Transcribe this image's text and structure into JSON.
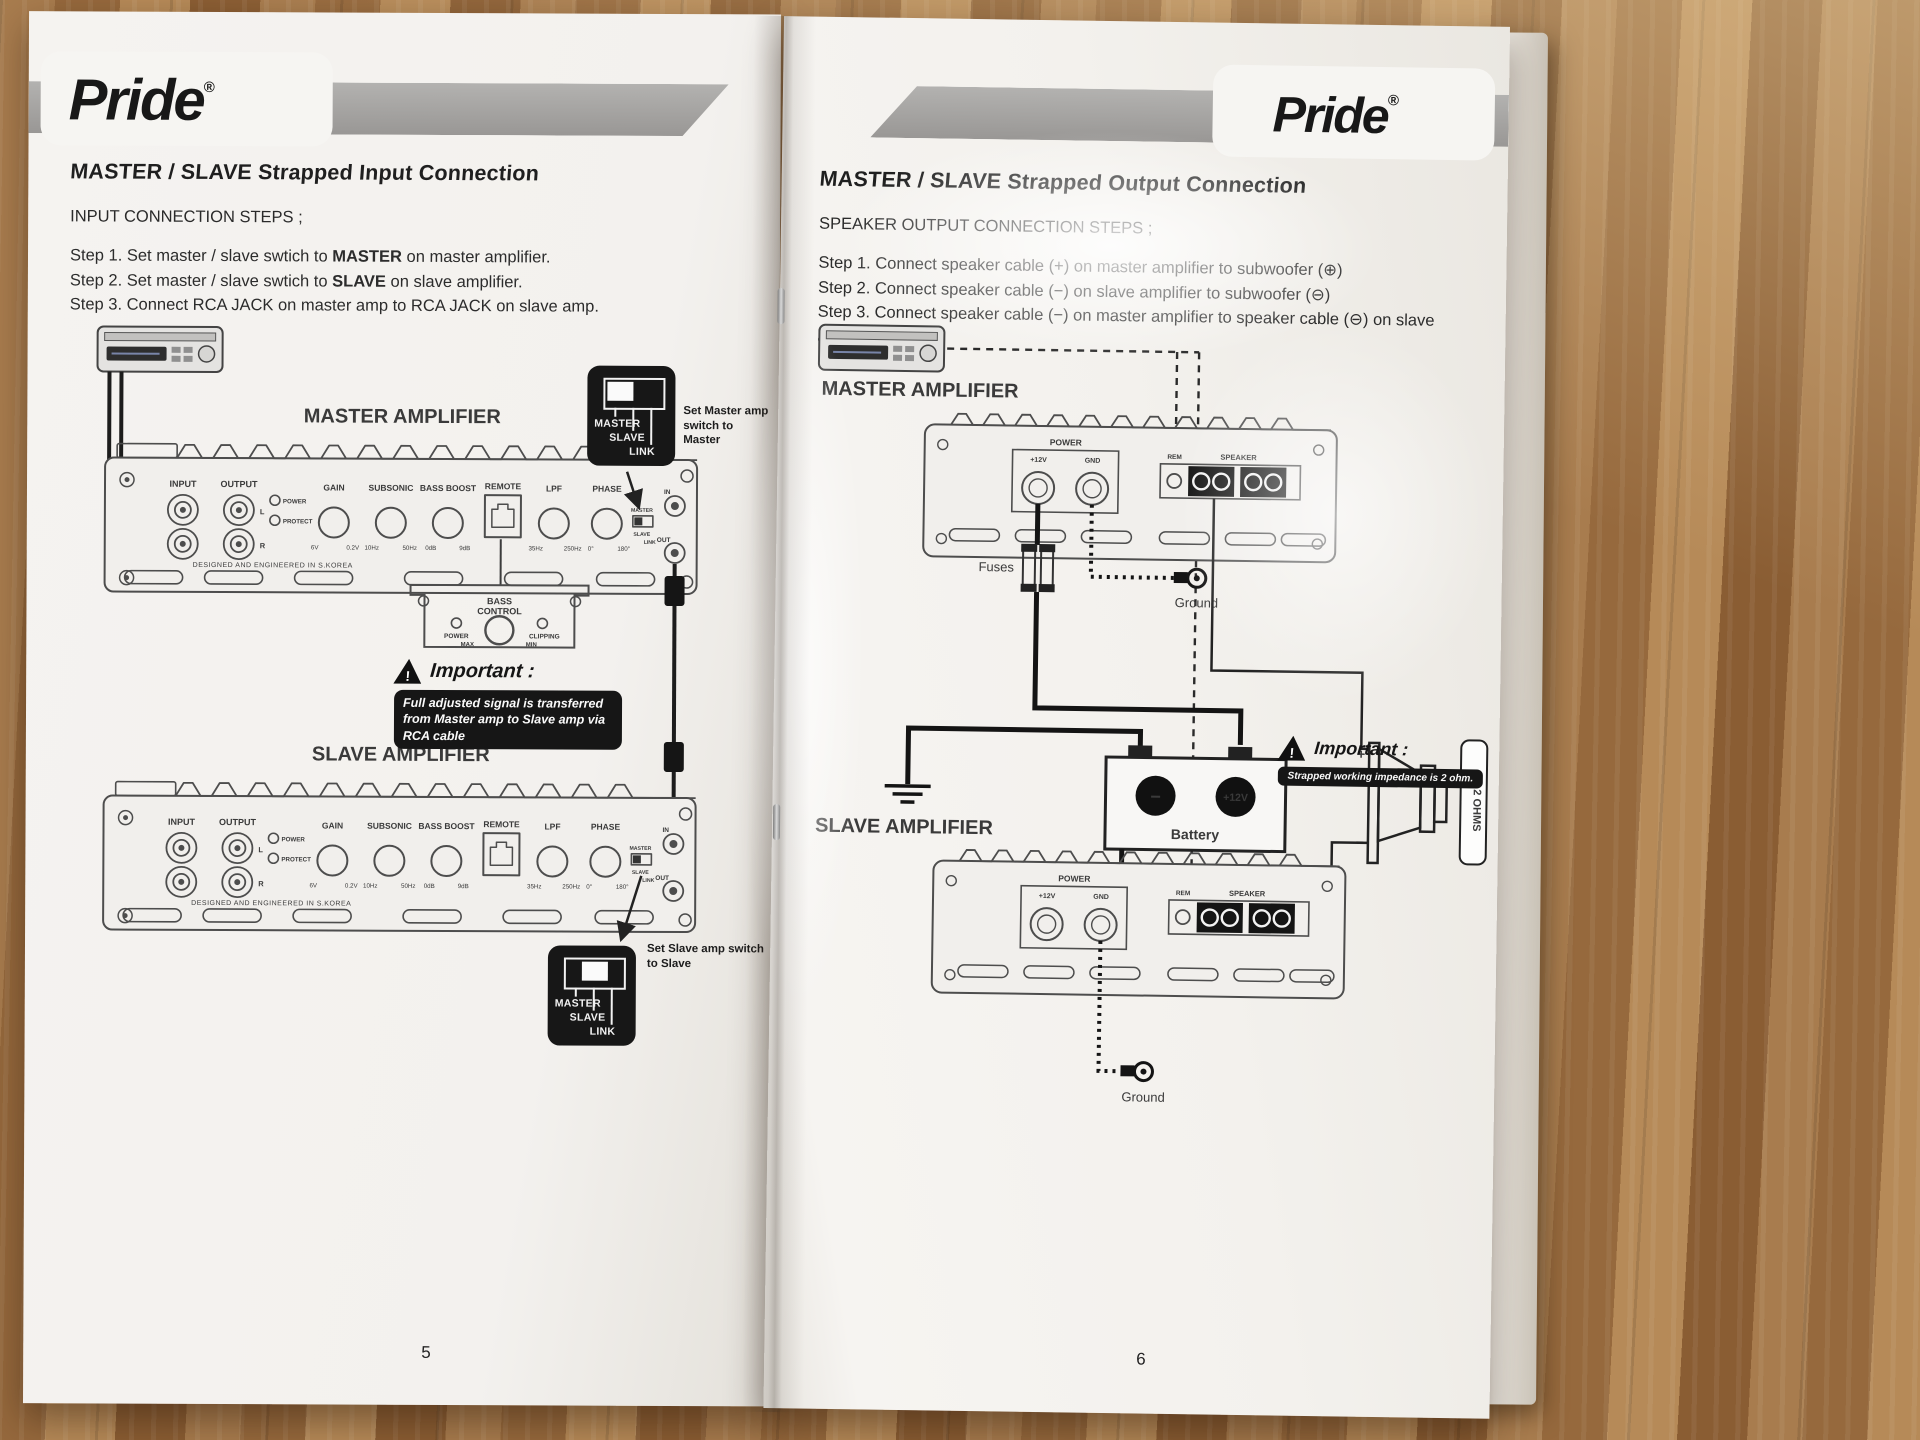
{
  "brand": {
    "name": "Pride",
    "reg": "®"
  },
  "warn_glyph": "!",
  "left": {
    "page_no": "5",
    "title": "MASTER / SLAVE Strapped Input Connection",
    "subtitle": "INPUT CONNECTION STEPS ;",
    "step1_pre": "Step 1. Set master / slave swtich to ",
    "step1_bold": "MASTER",
    "step1_post": " on master amplifier.",
    "step2_pre": "Step 2. Set master / slave swtich to ",
    "step2_bold": "SLAVE",
    "step2_post": " on slave amplifier.",
    "step3": "Step 3. Connect  RCA JACK on master amp to RCA JACK on slave amp.",
    "master_label": "MASTER AMPLIFIER",
    "slave_label": "SLAVE AMPLIFIER",
    "note_master": "Set Master amp switch to Master",
    "note_slave": "Set Slave amp switch to Slave",
    "important_title": "Important :",
    "important_text": "Full adjusted signal is transferred from Master amp to Slave amp via RCA cable"
  },
  "switchbox": {
    "master": "MASTER",
    "slave": "SLAVE",
    "link": "LINK"
  },
  "amp": {
    "input": "INPUT",
    "output": "OUTPUT",
    "l": "L",
    "r": "R",
    "power": "POWER",
    "protect": "PROTECT",
    "gain": "GAIN",
    "gain_lo": "6V",
    "gain_hi": "0.2V",
    "subsonic": "SUBSONIC",
    "sub_lo": "10Hz",
    "sub_hi": "50Hz",
    "bass": "BASS BOOST",
    "bass_lo": "0dB",
    "bass_hi": "9dB",
    "remote": "REMOTE",
    "lpf": "LPF",
    "lpf_lo": "35Hz",
    "lpf_hi": "250Hz",
    "phase": "PHASE",
    "phase_lo": "0°",
    "phase_hi": "180°",
    "master": "MASTER",
    "slave": "SLAVE",
    "link": "LINK",
    "in": "IN",
    "out": "OUT",
    "origin": "DESIGNED AND ENGINEERED IN S.KOREA"
  },
  "bass_remote": {
    "line1": "BASS",
    "line2": "CONTROL",
    "power": "POWER",
    "clipping": "CLIPPING",
    "max": "MAX",
    "min": "MIN"
  },
  "right": {
    "page_no": "6",
    "title": "MASTER / SLAVE Strapped Output Connection",
    "subtitle": "SPEAKER OUTPUT CONNECTION STEPS ;",
    "step1": "Step 1. Connect speaker cable (+) on master amplifier to subwoofer (⊕)",
    "step2": "Step 2. Connect speaker cable (−) on slave amplifier to subwoofer (⊖)",
    "step3": "Step 3. Connect speaker cable (−) on master amplifier to speaker cable (⊖) on slave  amplifier",
    "master_label": "MASTER AMPLIFIER",
    "slave_label": "SLAVE AMPLIFIER",
    "power": "POWER",
    "v12": "+12V",
    "gnd": "GND",
    "rem": "REM",
    "speaker": "SPEAKER",
    "fuses": "Fuses",
    "ground": "Ground",
    "battery": "Battery",
    "bat_minus": "−",
    "bat_plus": "+12V",
    "ohms": "4 - 2 OHMS",
    "important_title": "Important :",
    "important_text": "Strapped working impedance is 2 ohm."
  }
}
